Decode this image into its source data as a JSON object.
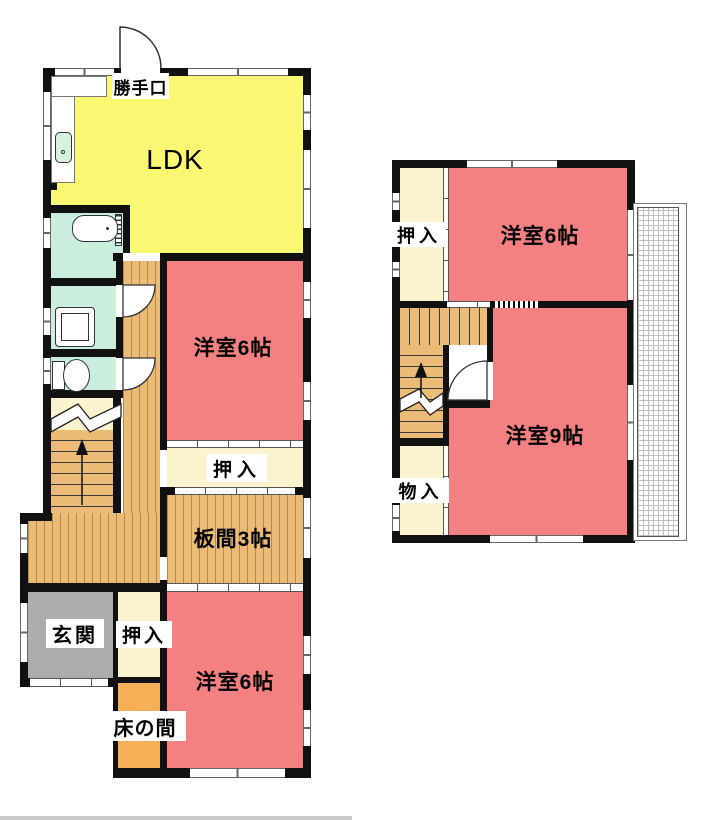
{
  "floor1": {
    "labels": {
      "katteguchi": "勝手口",
      "ldk": "LDK",
      "yoshitsu6_mid": "洋室6帖",
      "oshiire_mid": "押入",
      "itanoma": "板間3帖",
      "genkan": "玄関",
      "oshiire_lower": "押入",
      "tokonoma": "床の間",
      "yoshitsu6_lower": "洋室6帖"
    }
  },
  "floor2": {
    "labels": {
      "oshiire": "押入",
      "yoshitsu6": "洋室6帖",
      "mononyu": "物入",
      "yoshitsu9": "洋室9帖"
    }
  },
  "colors": {
    "room_red": "#F48181",
    "ldk_yellow": "#FAF772",
    "closet_cream": "#FAF3CE",
    "flooring_tan": "#EBBC77",
    "genkan_gray": "#ACACAC",
    "sanitary_mint": "#CBEDDC",
    "tokonoma_orange": "#F6AF57",
    "wall_black": "#111111"
  }
}
